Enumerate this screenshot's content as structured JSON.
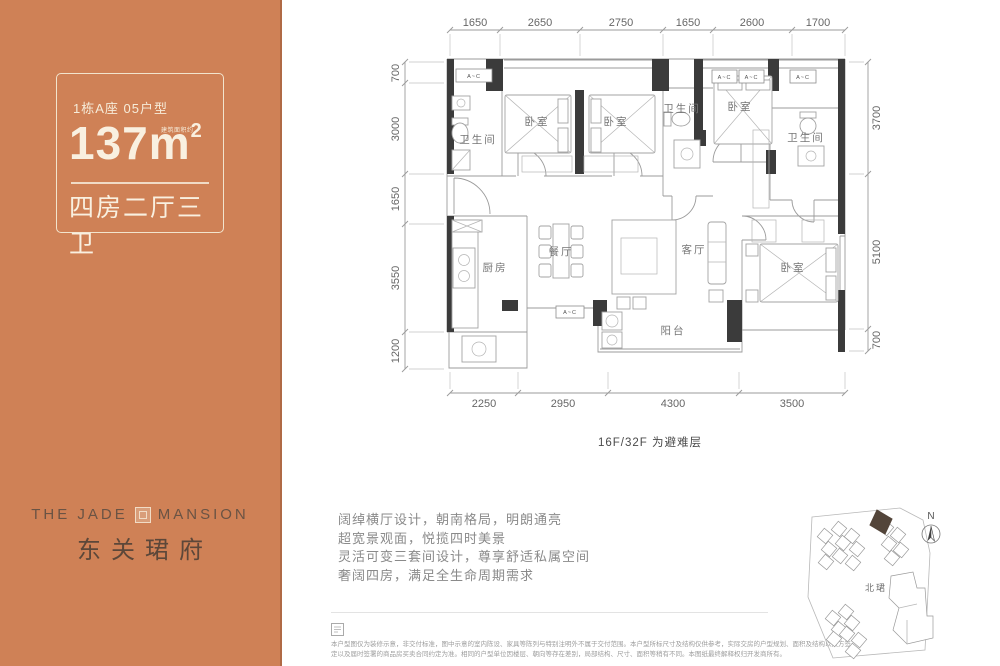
{
  "left_panel": {
    "unit_label": "1栋A座 05户型",
    "area_number": "137",
    "area_unit": "m",
    "area_sup": "2",
    "area_note": "建筑面积约",
    "layout_label": "四房二厅三卫",
    "brand": {
      "en_left": "THE JADE",
      "en_right": "MANSION",
      "cn": "东关珺府"
    },
    "colors": {
      "panel_bg": "#cf8156",
      "panel_text": "#f9f0e0",
      "brand_text": "#5c4739"
    }
  },
  "floorplan": {
    "note": "16F/32F 为避难层",
    "ac_label": "A~C",
    "dims": {
      "top": [
        {
          "t": "1650",
          "x": 475,
          "y": 26
        },
        {
          "t": "2650",
          "x": 540,
          "y": 26
        },
        {
          "t": "2750",
          "x": 621,
          "y": 26
        },
        {
          "t": "1650",
          "x": 688,
          "y": 26
        },
        {
          "t": "2600",
          "x": 752,
          "y": 26
        },
        {
          "t": "1700",
          "x": 818,
          "y": 26
        }
      ],
      "left": [
        {
          "t": "700",
          "x": 399,
          "y": 73,
          "rot": -90
        },
        {
          "t": "3000",
          "x": 399,
          "y": 129,
          "rot": -90
        },
        {
          "t": "1650",
          "x": 399,
          "y": 199,
          "rot": -90
        },
        {
          "t": "3550",
          "x": 399,
          "y": 278,
          "rot": -90
        },
        {
          "t": "1200",
          "x": 399,
          "y": 351,
          "rot": -90
        }
      ],
      "right": [
        {
          "t": "3700",
          "x": 880,
          "y": 118,
          "rot": -90
        },
        {
          "t": "5100",
          "x": 880,
          "y": 252,
          "rot": -90
        },
        {
          "t": "700",
          "x": 880,
          "y": 340,
          "rot": -90
        }
      ],
      "bottom": [
        {
          "t": "2250",
          "x": 484,
          "y": 407
        },
        {
          "t": "2950",
          "x": 563,
          "y": 407
        },
        {
          "t": "4300",
          "x": 673,
          "y": 407
        },
        {
          "t": "3500",
          "x": 792,
          "y": 407
        }
      ]
    },
    "rooms": [
      {
        "label": "卫生间",
        "x": 478,
        "y": 143
      },
      {
        "label": "卧室",
        "x": 537,
        "y": 125
      },
      {
        "label": "卧室",
        "x": 616,
        "y": 125
      },
      {
        "label": "卫生间",
        "x": 682,
        "y": 112
      },
      {
        "label": "卧室",
        "x": 740,
        "y": 110
      },
      {
        "label": "卫生间",
        "x": 806,
        "y": 141
      },
      {
        "label": "厨房",
        "x": 495,
        "y": 271
      },
      {
        "label": "餐厅",
        "x": 561,
        "y": 255
      },
      {
        "label": "客厅",
        "x": 694,
        "y": 253
      },
      {
        "label": "卧室",
        "x": 793,
        "y": 271
      },
      {
        "label": "阳台",
        "x": 673,
        "y": 334
      }
    ],
    "ac_units": [
      {
        "x": 456,
        "y": 69,
        "w": 36,
        "h": 13
      },
      {
        "x": 712,
        "y": 70,
        "w": 25,
        "h": 13
      },
      {
        "x": 739,
        "y": 70,
        "w": 25,
        "h": 13
      },
      {
        "x": 790,
        "y": 70,
        "w": 26,
        "h": 13
      },
      {
        "x": 556,
        "y": 306,
        "w": 28,
        "h": 12
      }
    ]
  },
  "marketing": {
    "lines": [
      "阔绰横厅设计，朝南格局，明朗通亮",
      "超宽景观面，悦揽四时美景",
      "灵活可变三套间设计，尊享舒适私属空间",
      "奢阔四房，满足全生命周期需求"
    ]
  },
  "disclaimer": {
    "line1": "本户型图仅为装修示意，非交付标准，图中示意的室内陈设、家具等陈列与特别注明外不属于交付范围。本户型所标尺寸及结构仅供参考，实际交房的户型规划、面积及结构以双方签",
    "line2": "定以及届时签署的商品房买卖合同约定为准。相同的户型单位因楼层、朝向等存在差别，局部结构、尺寸、面积等稍有不同。本图纸最终解释权归开发商所有。"
  },
  "sitemap": {
    "area_label": "北珺",
    "compass": "N"
  }
}
